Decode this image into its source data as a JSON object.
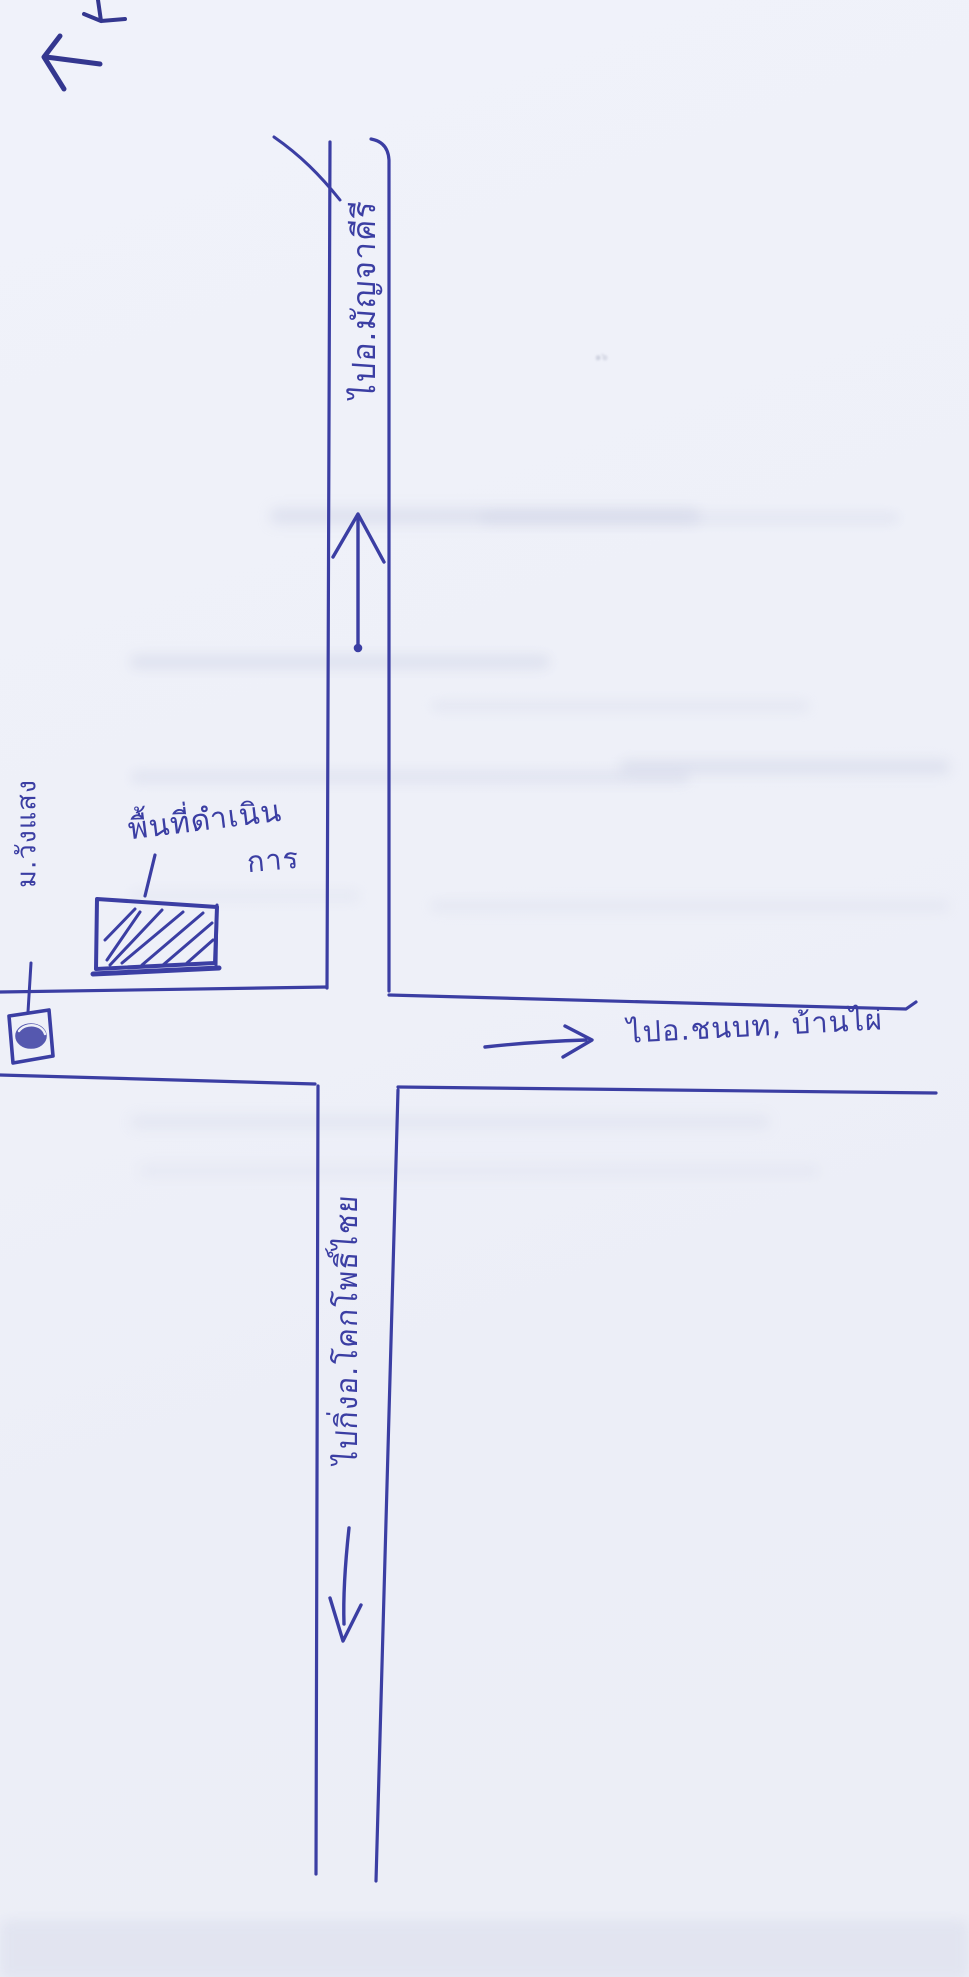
{
  "palette": {
    "paper": "#eef0f8",
    "ink": "#3b3ea3",
    "ink_dark": "#34378f"
  },
  "map": {
    "roads": {
      "top_label": "ไปอ.มัญจาคีรี",
      "bottom_label": "ไปกิ่งอ.โคกโพธิ์ไชย",
      "right_label": "ไปอ.ชนบท, บ้านไผ่"
    },
    "site": {
      "label_line1": "พื้นที่ดำเนิน",
      "label_line2": "การ"
    },
    "left_landmark_label": "ม.วังแสง",
    "smudge_mark": "๑๖"
  }
}
